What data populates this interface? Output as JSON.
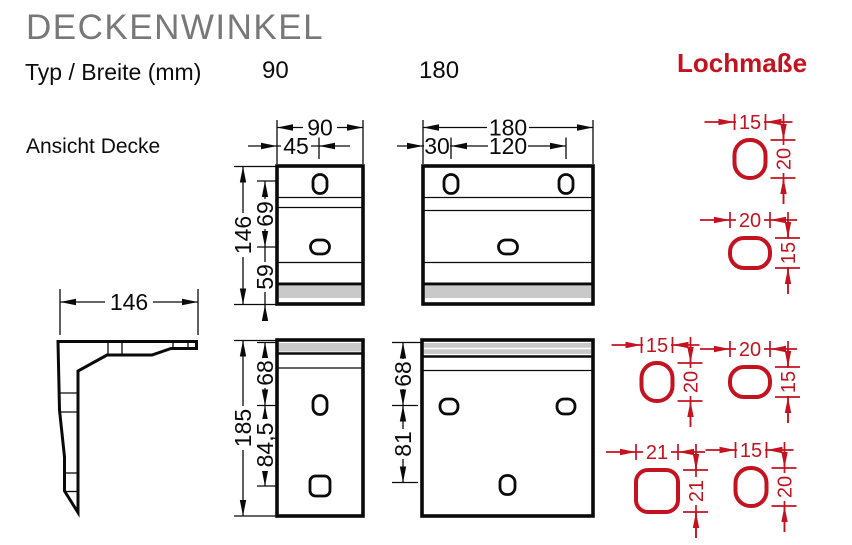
{
  "header": {
    "title": "DECKENWINKEL",
    "type_row_label": "Typ / Breite (mm)",
    "type_90": "90",
    "type_180": "180",
    "holes_title": "Lochmaße",
    "view_label": "Ansicht Decke"
  },
  "colors": {
    "accent_red": "#c41320",
    "band_gray": "#c9c9c9",
    "title_gray": "#787878",
    "line_black": "#0a0a0a"
  },
  "side_view": {
    "depth": "146"
  },
  "type90_ceiling": {
    "width": "90",
    "hole_center": "45",
    "length": "146",
    "hole_spacing": "69",
    "hole_to_edge": "59"
  },
  "type180_ceiling": {
    "width": "180",
    "edge_to_hole": "30",
    "hole_spacing": "120"
  },
  "type90_wall": {
    "length": "185",
    "edge_to_hole": "68",
    "hole_spacing": "84,5"
  },
  "type180_wall": {
    "edge_to_hole": "68",
    "hole_spacing": "81"
  },
  "hole_details": [
    {
      "w": "15",
      "h": "20"
    },
    {
      "w": "20",
      "h": "15"
    },
    {
      "w": "15",
      "h": "20"
    },
    {
      "w": "20",
      "h": "15"
    },
    {
      "w": "21",
      "h": "21"
    },
    {
      "w": "15",
      "h": "20"
    }
  ]
}
